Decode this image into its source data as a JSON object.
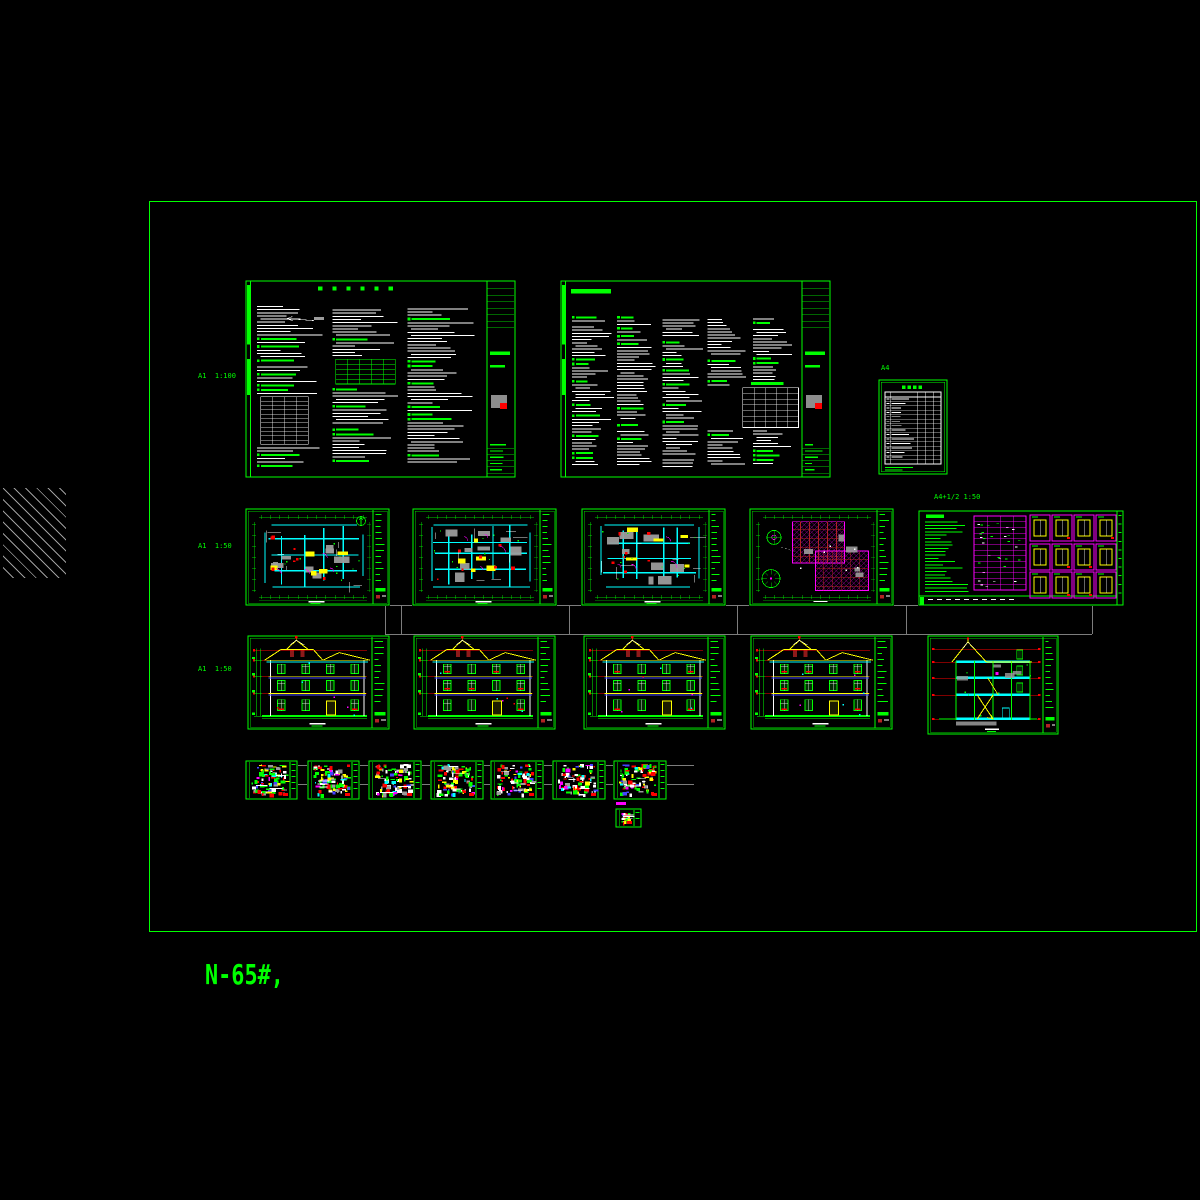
{
  "workspace": {
    "width": 1200,
    "height": 1200
  },
  "colors": {
    "background": "#000000",
    "frame_green": "#00ff00",
    "hatch_gray": "#9c9c9c",
    "connector_gray": "#7d7d7d",
    "wall_cyan": "#00ffff",
    "accent_yellow": "#ffff00",
    "accent_red": "#ff0000",
    "accent_magenta": "#ff00ff",
    "accent_blue": "#4444ff",
    "fill_gray": "#9c9c9c",
    "ridge_dark_red": "#b22222",
    "text_white": "#ffffff"
  },
  "labels": {
    "row1_scale": {
      "text": "A1  1:100"
    },
    "a4": {
      "text": "A4"
    },
    "row2_wide_scale": {
      "text": "A4+1/2 1:50"
    },
    "row2_scale": {
      "text": "A1  1:50"
    },
    "row3_scale": {
      "text": "A1  1:50"
    }
  },
  "footer": {
    "text": "N-65#,"
  },
  "sheets": [
    {
      "id": "general-notes-1",
      "type": "spec",
      "cols": 3,
      "x": 245,
      "y": 280,
      "w": 271,
      "h": 198,
      "seed": 11
    },
    {
      "id": "general-notes-2",
      "type": "spec",
      "cols": 5,
      "x": 560,
      "y": 280,
      "w": 271,
      "h": 198,
      "seed": 12
    },
    {
      "id": "drawing-list",
      "type": "list",
      "x": 878,
      "y": 379,
      "w": 70,
      "h": 96,
      "seed": 13
    },
    {
      "id": "floor-plan-1",
      "type": "plan",
      "north": true,
      "x": 245,
      "y": 508,
      "w": 145,
      "h": 98,
      "seed": 21
    },
    {
      "id": "floor-plan-2",
      "type": "plan",
      "x": 412,
      "y": 508,
      "w": 145,
      "h": 98,
      "seed": 22
    },
    {
      "id": "floor-plan-3",
      "type": "plan",
      "x": 581,
      "y": 508,
      "w": 145,
      "h": 98,
      "seed": 23
    },
    {
      "id": "roof-plan",
      "type": "roof",
      "x": 749,
      "y": 508,
      "w": 145,
      "h": 98,
      "seed": 24
    },
    {
      "id": "door-window-schedule",
      "type": "schedule",
      "x": 918,
      "y": 510,
      "w": 206,
      "h": 96,
      "seed": 25
    },
    {
      "id": "elevation-1",
      "type": "elevation",
      "x": 247,
      "y": 635,
      "w": 143,
      "h": 95,
      "seed": 31
    },
    {
      "id": "elevation-2",
      "type": "elevation",
      "x": 413,
      "y": 635,
      "w": 143,
      "h": 95,
      "seed": 32
    },
    {
      "id": "elevation-3",
      "type": "elevation",
      "x": 583,
      "y": 635,
      "w": 143,
      "h": 95,
      "seed": 33
    },
    {
      "id": "elevation-4",
      "type": "elevation",
      "x": 750,
      "y": 635,
      "w": 143,
      "h": 95,
      "seed": 34
    },
    {
      "id": "building-section",
      "type": "section",
      "x": 927,
      "y": 635,
      "w": 132,
      "h": 100,
      "seed": 35
    },
    {
      "id": "detail-1",
      "type": "detail",
      "x": 245,
      "y": 760,
      "w": 53,
      "h": 40,
      "seed": 41
    },
    {
      "id": "detail-2",
      "type": "detail",
      "x": 307,
      "y": 760,
      "w": 53,
      "h": 40,
      "seed": 42
    },
    {
      "id": "detail-3",
      "type": "detail",
      "x": 368,
      "y": 760,
      "w": 54,
      "h": 40,
      "seed": 43
    },
    {
      "id": "detail-4",
      "type": "detail",
      "x": 430,
      "y": 760,
      "w": 54,
      "h": 40,
      "seed": 44
    },
    {
      "id": "detail-5",
      "type": "detail",
      "x": 490,
      "y": 760,
      "w": 54,
      "h": 40,
      "seed": 45
    },
    {
      "id": "detail-6",
      "type": "detail",
      "x": 552,
      "y": 760,
      "w": 54,
      "h": 40,
      "seed": 46
    },
    {
      "id": "detail-7",
      "type": "detail",
      "x": 613,
      "y": 760,
      "w": 54,
      "h": 40,
      "seed": 47
    },
    {
      "id": "detail-8",
      "type": "detail",
      "x": 615,
      "y": 808,
      "w": 27,
      "h": 20,
      "seed": 48
    }
  ],
  "connectors": {
    "h": [
      {
        "x1": 385,
        "y": 605,
        "x2": 1092
      },
      {
        "x1": 385,
        "y": 634,
        "x2": 1092
      },
      {
        "x1": 298,
        "y": 765,
        "x2": 694
      },
      {
        "x1": 298,
        "y": 784,
        "x2": 694
      }
    ],
    "v": [
      {
        "x": 385,
        "y1": 605,
        "y2": 634
      },
      {
        "x": 401,
        "y1": 605,
        "y2": 634
      },
      {
        "x": 569,
        "y1": 605,
        "y2": 634
      },
      {
        "x": 737,
        "y1": 605,
        "y2": 634
      },
      {
        "x": 906,
        "y1": 605,
        "y2": 634
      },
      {
        "x": 1092,
        "y1": 605,
        "y2": 634
      }
    ]
  }
}
